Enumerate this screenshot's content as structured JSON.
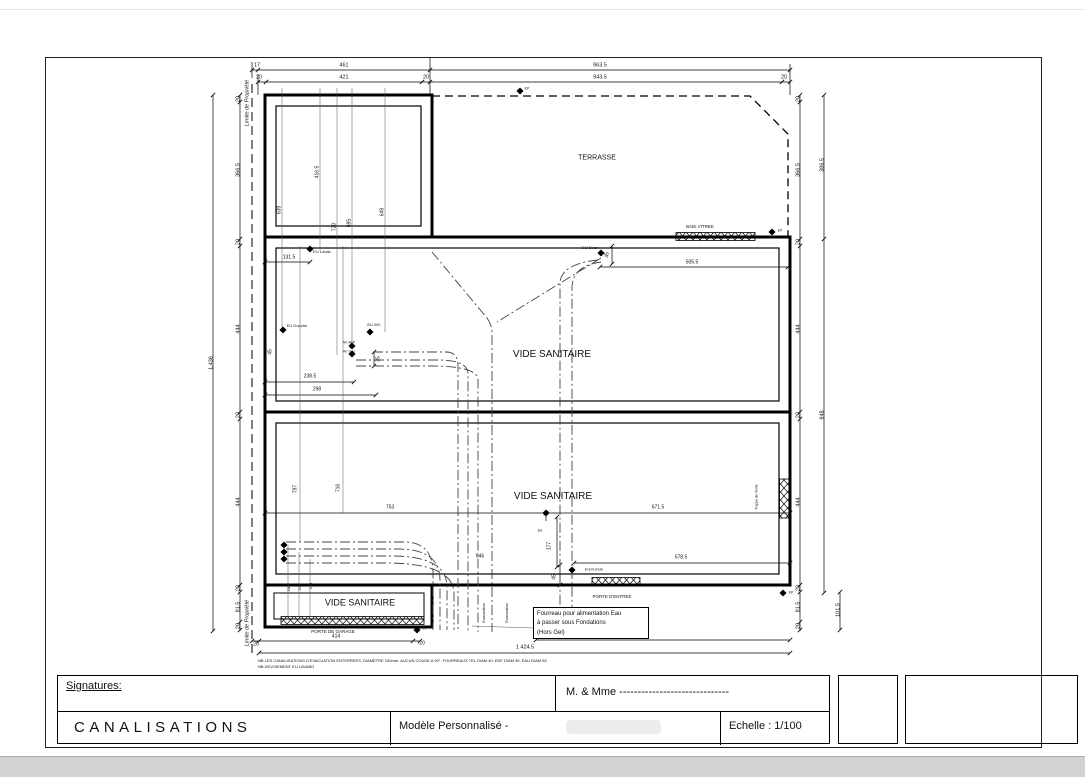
{
  "title_block": {
    "signatures_label": "Signatures:",
    "client_label": "M. & Mme ------------------------------",
    "drawing_title": "CANALISATIONS",
    "model_label": "Modèle Personnalisé -",
    "scale_label": "Echelle : 1/100"
  },
  "plan": {
    "fourreau_note": [
      "Fourreau pour alimentation Eau",
      "à passer sous Fondations",
      "(Hors Gel)"
    ],
    "labels": [
      {
        "t": "17",
        "x": 257,
        "y": 66
      },
      {
        "t": "461",
        "x": 344,
        "y": 66
      },
      {
        "t": "963.5",
        "x": 600,
        "y": 66
      },
      {
        "t": "20",
        "x": 259,
        "y": 78
      },
      {
        "t": "421",
        "x": 344,
        "y": 78
      },
      {
        "t": "20",
        "x": 426,
        "y": 78
      },
      {
        "t": "943.5",
        "x": 600,
        "y": 78
      },
      {
        "t": "20",
        "x": 784,
        "y": 78
      },
      {
        "t": "20",
        "x": 239,
        "y": 99,
        "r": -90
      },
      {
        "t": "366.5",
        "x": 239,
        "y": 170,
        "r": -90
      },
      {
        "t": "20",
        "x": 239,
        "y": 242,
        "r": -90
      },
      {
        "t": "444",
        "x": 239,
        "y": 329,
        "r": -90
      },
      {
        "t": "20",
        "x": 239,
        "y": 415,
        "r": -90
      },
      {
        "t": "444",
        "x": 239,
        "y": 502,
        "r": -90
      },
      {
        "t": "20",
        "x": 239,
        "y": 588,
        "r": -90
      },
      {
        "t": "81.5",
        "x": 239,
        "y": 607,
        "r": -90
      },
      {
        "t": "20",
        "x": 239,
        "y": 626,
        "r": -90
      },
      {
        "t": "1,436",
        "x": 212,
        "y": 363,
        "r": -90
      },
      {
        "t": "Limite de Propriété",
        "x": 248,
        "y": 103,
        "r": -90,
        "i": true,
        "n": "property-line-label"
      },
      {
        "t": "Limite de Propriété",
        "x": 248,
        "y": 623,
        "r": -90,
        "i": true,
        "n": "property-line-label"
      },
      {
        "t": "20",
        "x": 799,
        "y": 99,
        "r": -90
      },
      {
        "t": "366.5",
        "x": 799,
        "y": 170,
        "r": -90
      },
      {
        "t": "20",
        "x": 799,
        "y": 242,
        "r": -90
      },
      {
        "t": "444",
        "x": 799,
        "y": 329,
        "r": -90
      },
      {
        "t": "20",
        "x": 799,
        "y": 415,
        "r": -90
      },
      {
        "t": "444",
        "x": 799,
        "y": 502,
        "r": -90
      },
      {
        "t": "20",
        "x": 799,
        "y": 588,
        "r": -90
      },
      {
        "t": "81.5",
        "x": 799,
        "y": 607,
        "r": -90
      },
      {
        "t": "20",
        "x": 799,
        "y": 626,
        "r": -90
      },
      {
        "t": "386.5",
        "x": 823,
        "y": 165,
        "r": -90
      },
      {
        "t": "948",
        "x": 823,
        "y": 415,
        "r": -90
      },
      {
        "t": "101.5",
        "x": 839,
        "y": 610,
        "r": -90
      },
      {
        "t": "639",
        "x": 280,
        "y": 210,
        "r": -90,
        "s": 5
      },
      {
        "t": "416.5",
        "x": 318,
        "y": 172,
        "r": -90,
        "s": 5
      },
      {
        "t": "720",
        "x": 335,
        "y": 227,
        "r": -90,
        "s": 5
      },
      {
        "t": "695",
        "x": 350,
        "y": 223,
        "r": -90,
        "s": 5
      },
      {
        "t": "649",
        "x": 383,
        "y": 212,
        "r": -90,
        "s": 5
      },
      {
        "t": "131.5",
        "x": 289,
        "y": 258,
        "s": 5
      },
      {
        "t": "EU Lavab",
        "x": 322,
        "y": 252,
        "s": 4,
        "n": "fixture-label"
      },
      {
        "t": "EU Douche",
        "x": 297,
        "y": 326,
        "s": 4,
        "n": "fixture-label"
      },
      {
        "t": "EU WC",
        "x": 374,
        "y": 325,
        "s": 4,
        "n": "fixture-label"
      },
      {
        "t": "45",
        "x": 271,
        "y": 352,
        "r": -90,
        "s": 5
      },
      {
        "t": "238.5",
        "x": 310,
        "y": 377,
        "s": 5
      },
      {
        "t": "298",
        "x": 317,
        "y": 390,
        "s": 5
      },
      {
        "t": "35",
        "x": 379,
        "y": 359,
        "r": -90,
        "s": 5
      },
      {
        "t": "Arr AEP",
        "x": 349,
        "y": 343,
        "s": 3.5,
        "n": "fixture-label"
      },
      {
        "t": "Arr Gaz",
        "x": 349,
        "y": 352,
        "s": 3.5,
        "n": "fixture-label"
      },
      {
        "t": "TERRASSE",
        "x": 597,
        "y": 158,
        "s": 7,
        "n": "room-label"
      },
      {
        "t": "BAIE VITREE",
        "x": 700,
        "y": 227,
        "s": 4.5,
        "n": "fixture-label"
      },
      {
        "t": "EP",
        "x": 780,
        "y": 231,
        "s": 3.5,
        "n": "ep-marker-label"
      },
      {
        "t": "EP",
        "x": 527,
        "y": 89,
        "s": 3.5,
        "n": "ep-marker-label"
      },
      {
        "t": "EU Evier",
        "x": 590,
        "y": 248,
        "s": 4,
        "n": "fixture-label"
      },
      {
        "t": "45",
        "x": 608,
        "y": 255,
        "r": -90,
        "s": 5
      },
      {
        "t": "505.5",
        "x": 692,
        "y": 263,
        "s": 5
      },
      {
        "t": "VIDE SANITAIRE",
        "x": 552,
        "y": 355,
        "s": 10,
        "n": "room-label"
      },
      {
        "t": "VIDE SANITAIRE",
        "x": 553,
        "y": 497,
        "s": 10,
        "n": "room-label"
      },
      {
        "t": "797",
        "x": 296,
        "y": 489,
        "r": -90,
        "s": 5
      },
      {
        "t": "716",
        "x": 339,
        "y": 488,
        "r": -90,
        "s": 5
      },
      {
        "t": "753",
        "x": 390,
        "y": 508,
        "s": 5
      },
      {
        "t": "671.5",
        "x": 658,
        "y": 508,
        "s": 5
      },
      {
        "t": "EU",
        "x": 540,
        "y": 531,
        "s": 3.5,
        "n": "fixture-label"
      },
      {
        "t": "177",
        "x": 550,
        "y": 546,
        "r": -90,
        "s": 5
      },
      {
        "t": "578.5",
        "x": 681,
        "y": 558,
        "s": 5
      },
      {
        "t": "Event chute",
        "x": 594,
        "y": 570,
        "s": 3.5,
        "n": "fixture-label"
      },
      {
        "t": "45",
        "x": 555,
        "y": 577,
        "r": -90,
        "s": 5
      },
      {
        "t": "646",
        "x": 480,
        "y": 557,
        "s": 5
      },
      {
        "t": "Trappe de Visite",
        "x": 757,
        "y": 497,
        "r": -90,
        "s": 3.5,
        "n": "fixture-label"
      },
      {
        "t": "VIDE SANITAIRE",
        "x": 360,
        "y": 603,
        "s": 9,
        "n": "room-label"
      },
      {
        "t": "185",
        "x": 289,
        "y": 588,
        "r": -90,
        "s": 4
      },
      {
        "t": "203",
        "x": 300,
        "y": 587,
        "r": -90,
        "s": 4
      },
      {
        "t": "218",
        "x": 311,
        "y": 586,
        "r": -90,
        "s": 4
      },
      {
        "t": "Evacuation",
        "x": 484,
        "y": 613,
        "r": -90,
        "s": 4,
        "n": "fixture-label"
      },
      {
        "t": "Evacuation",
        "x": 507,
        "y": 613,
        "r": -90,
        "s": 4,
        "n": "fixture-label"
      },
      {
        "t": "PORTE D'ENTREE",
        "x": 612,
        "y": 597,
        "s": 4.5,
        "n": "fixture-label"
      },
      {
        "t": "EP",
        "x": 791,
        "y": 593,
        "s": 3.5,
        "n": "ep-marker-label"
      },
      {
        "t": "PORTE DE GARAGE",
        "x": 333,
        "y": 632,
        "s": 4.5,
        "n": "fixture-label"
      },
      {
        "t": "EP",
        "x": 425,
        "y": 629,
        "s": 3.5,
        "n": "ep-marker-label"
      },
      {
        "t": "20",
        "x": 256,
        "y": 645,
        "s": 5
      },
      {
        "t": "414",
        "x": 336,
        "y": 637,
        "s": 5
      },
      {
        "t": "20",
        "x": 422,
        "y": 644,
        "s": 5
      },
      {
        "t": "950.5",
        "x": 620,
        "y": 634,
        "s": 5
      },
      {
        "t": "1 424.5",
        "x": 525,
        "y": 648,
        "s": 5.5
      },
      {
        "t": "NB  LES CANALISATIONS D'EVACUATION ENTERREES, DIAMETRE 100mm, AUCUN COUDE A 90°, FOURREAUX TEL DIAM 40; EDF DIAM 90; EAU DIAM 63",
        "x": 258,
        "y": 661,
        "s": 4,
        "a": "l",
        "n": "note-text"
      },
      {
        "t": "NB  DEVOIEMENT EU LAVABO",
        "x": 258,
        "y": 667,
        "s": 4,
        "a": "l",
        "n": "note-text"
      }
    ]
  }
}
